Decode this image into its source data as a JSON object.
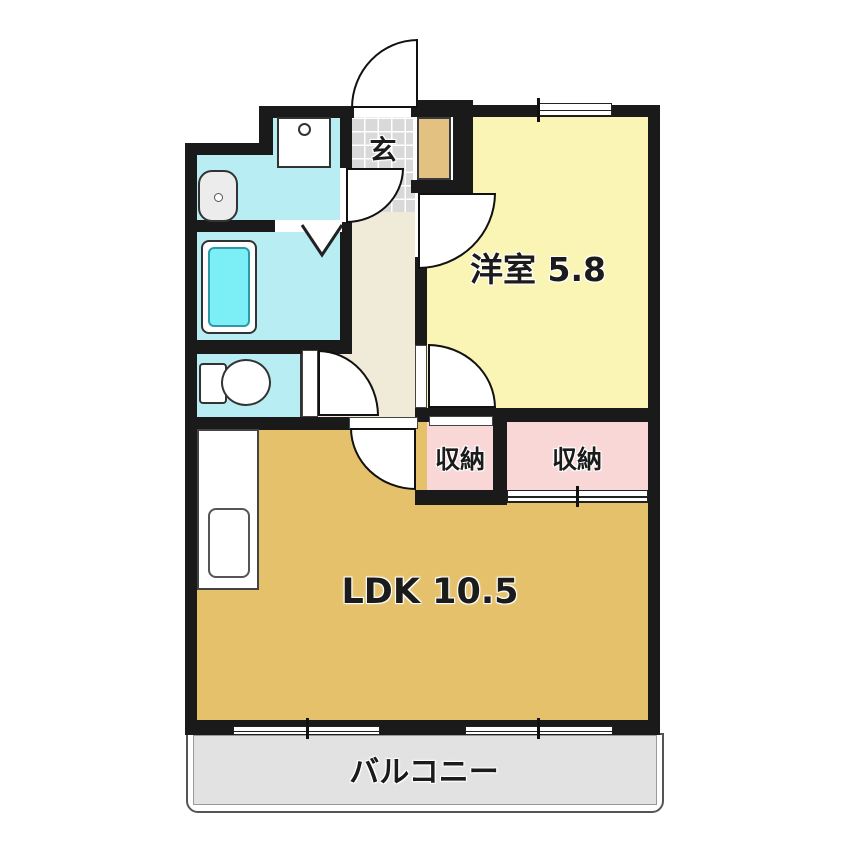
{
  "plan": {
    "type": "apartment-floorplan",
    "rooms": {
      "genkan": {
        "label": "玄"
      },
      "western_room": {
        "label": "洋室 5.8"
      },
      "closet_left": {
        "label": "収納"
      },
      "closet_right": {
        "label": "収納"
      },
      "ldk": {
        "label": "LDK 10.5"
      },
      "balcony": {
        "label": "バルコニー"
      }
    },
    "fixtures": [
      "washing-machine-pan",
      "vanity-sink",
      "bathtub",
      "toilet",
      "kitchen-counter",
      "shoe-cabinet"
    ],
    "colors": {
      "wall": "#1a1a1a",
      "western_room": "#faf5b4",
      "ldk": "#e5c16b",
      "closet": "#f9d7d7",
      "wet_rooms": "#b8eef3",
      "bathtub": "#7ceef5",
      "genkan_tile": "#d9d9d9",
      "hallway": "#f0ead9",
      "shoe_cabinet": "#e3c180",
      "balcony": "#e2e2e2"
    }
  }
}
